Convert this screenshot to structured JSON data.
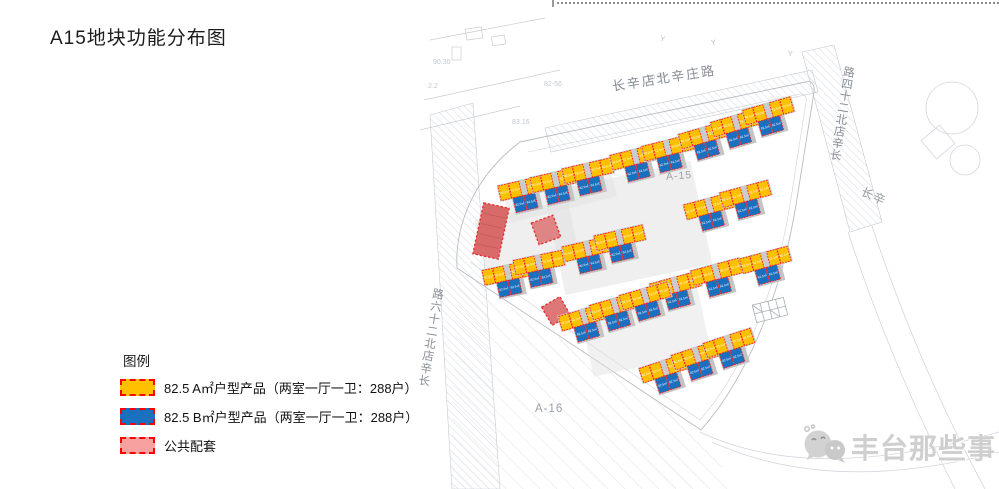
{
  "slide": {
    "title": "A15地块功能分布图"
  },
  "legend": {
    "heading": "图例",
    "items": [
      {
        "id": "unit-a",
        "label": "82.5 A㎡户型产品（两室一厅一卫：288户）",
        "color": "#FFC000"
      },
      {
        "id": "unit-b",
        "label": "82.5 B㎡户型产品（两室一厅一卫：288户）",
        "color": "#1B6FBF"
      },
      {
        "id": "public",
        "label": "公共配套",
        "color": "#F8A1A1"
      }
    ]
  },
  "colors": {
    "unit_a": "#FFC000",
    "unit_b": "#1B6FBF",
    "public_legend": "#F8A1A1",
    "public_large": "#D96A6A",
    "public_small": "#E08383",
    "unit_border": "#FF1E1E"
  },
  "map": {
    "unit_label": "82.5㎡",
    "road_labels": [
      {
        "name": "长辛店北辛庄路"
      },
      {
        "name": "长辛店北二十四路"
      },
      {
        "name": "长辛店北二十六路"
      },
      {
        "name": "长辛"
      }
    ],
    "area_labels": [
      {
        "name": "A-15"
      },
      {
        "name": "A-16"
      }
    ],
    "clusters": [
      {
        "x": 526,
        "y": 197,
        "r": -13
      },
      {
        "x": 558,
        "y": 189,
        "r": -13
      },
      {
        "x": 590,
        "y": 180,
        "r": -13
      },
      {
        "x": 638,
        "y": 166,
        "r": -14
      },
      {
        "x": 670,
        "y": 157,
        "r": -14
      },
      {
        "x": 707,
        "y": 144,
        "r": -16
      },
      {
        "x": 739,
        "y": 132,
        "r": -16
      },
      {
        "x": 771,
        "y": 120,
        "r": -16
      },
      {
        "x": 712,
        "y": 215,
        "r": -15
      },
      {
        "x": 748,
        "y": 203,
        "r": -15
      },
      {
        "x": 590,
        "y": 258,
        "r": -13
      },
      {
        "x": 622,
        "y": 247,
        "r": -13
      },
      {
        "x": 510,
        "y": 282,
        "r": -12
      },
      {
        "x": 541,
        "y": 272,
        "r": -12
      },
      {
        "x": 678,
        "y": 294,
        "r": -15
      },
      {
        "x": 719,
        "y": 281,
        "r": -15
      },
      {
        "x": 768,
        "y": 269,
        "r": -15
      },
      {
        "x": 587,
        "y": 326,
        "r": -16
      },
      {
        "x": 618,
        "y": 315,
        "r": -16
      },
      {
        "x": 648,
        "y": 305,
        "r": -16
      },
      {
        "x": 668,
        "y": 377,
        "r": -18
      },
      {
        "x": 700,
        "y": 364,
        "r": -18
      },
      {
        "x": 732,
        "y": 352,
        "r": -18
      }
    ],
    "public_blocks": [
      {
        "kind": "large",
        "x": 491,
        "y": 231,
        "w": 26,
        "h": 52,
        "r": 12,
        "fill": "#D96A6A"
      },
      {
        "kind": "small",
        "x": 546,
        "y": 230,
        "w": 23,
        "h": 23,
        "r": -20,
        "fill": "#E08585"
      },
      {
        "kind": "small",
        "x": 556,
        "y": 311,
        "w": 21,
        "h": 21,
        "r": -30,
        "fill": "#DD7878"
      }
    ],
    "background_labels": [
      {
        "text": "80.80",
        "x": 648,
        "y": 80,
        "r": -9
      },
      {
        "text": "82-56",
        "x": 544,
        "y": 86,
        "r": 0
      },
      {
        "text": "90.30",
        "x": 433,
        "y": 64,
        "r": 0
      },
      {
        "text": "2.2",
        "x": 428,
        "y": 88,
        "r": 0
      },
      {
        "text": "83.16",
        "x": 512,
        "y": 124,
        "r": 0
      }
    ],
    "survey_marks": [
      {
        "x": 662,
        "y": 41,
        "r": 15
      },
      {
        "x": 714,
        "y": 45,
        "r": -10
      },
      {
        "x": 790,
        "y": 56,
        "r": 5
      }
    ]
  },
  "watermark": {
    "text": "丰台那些事"
  }
}
